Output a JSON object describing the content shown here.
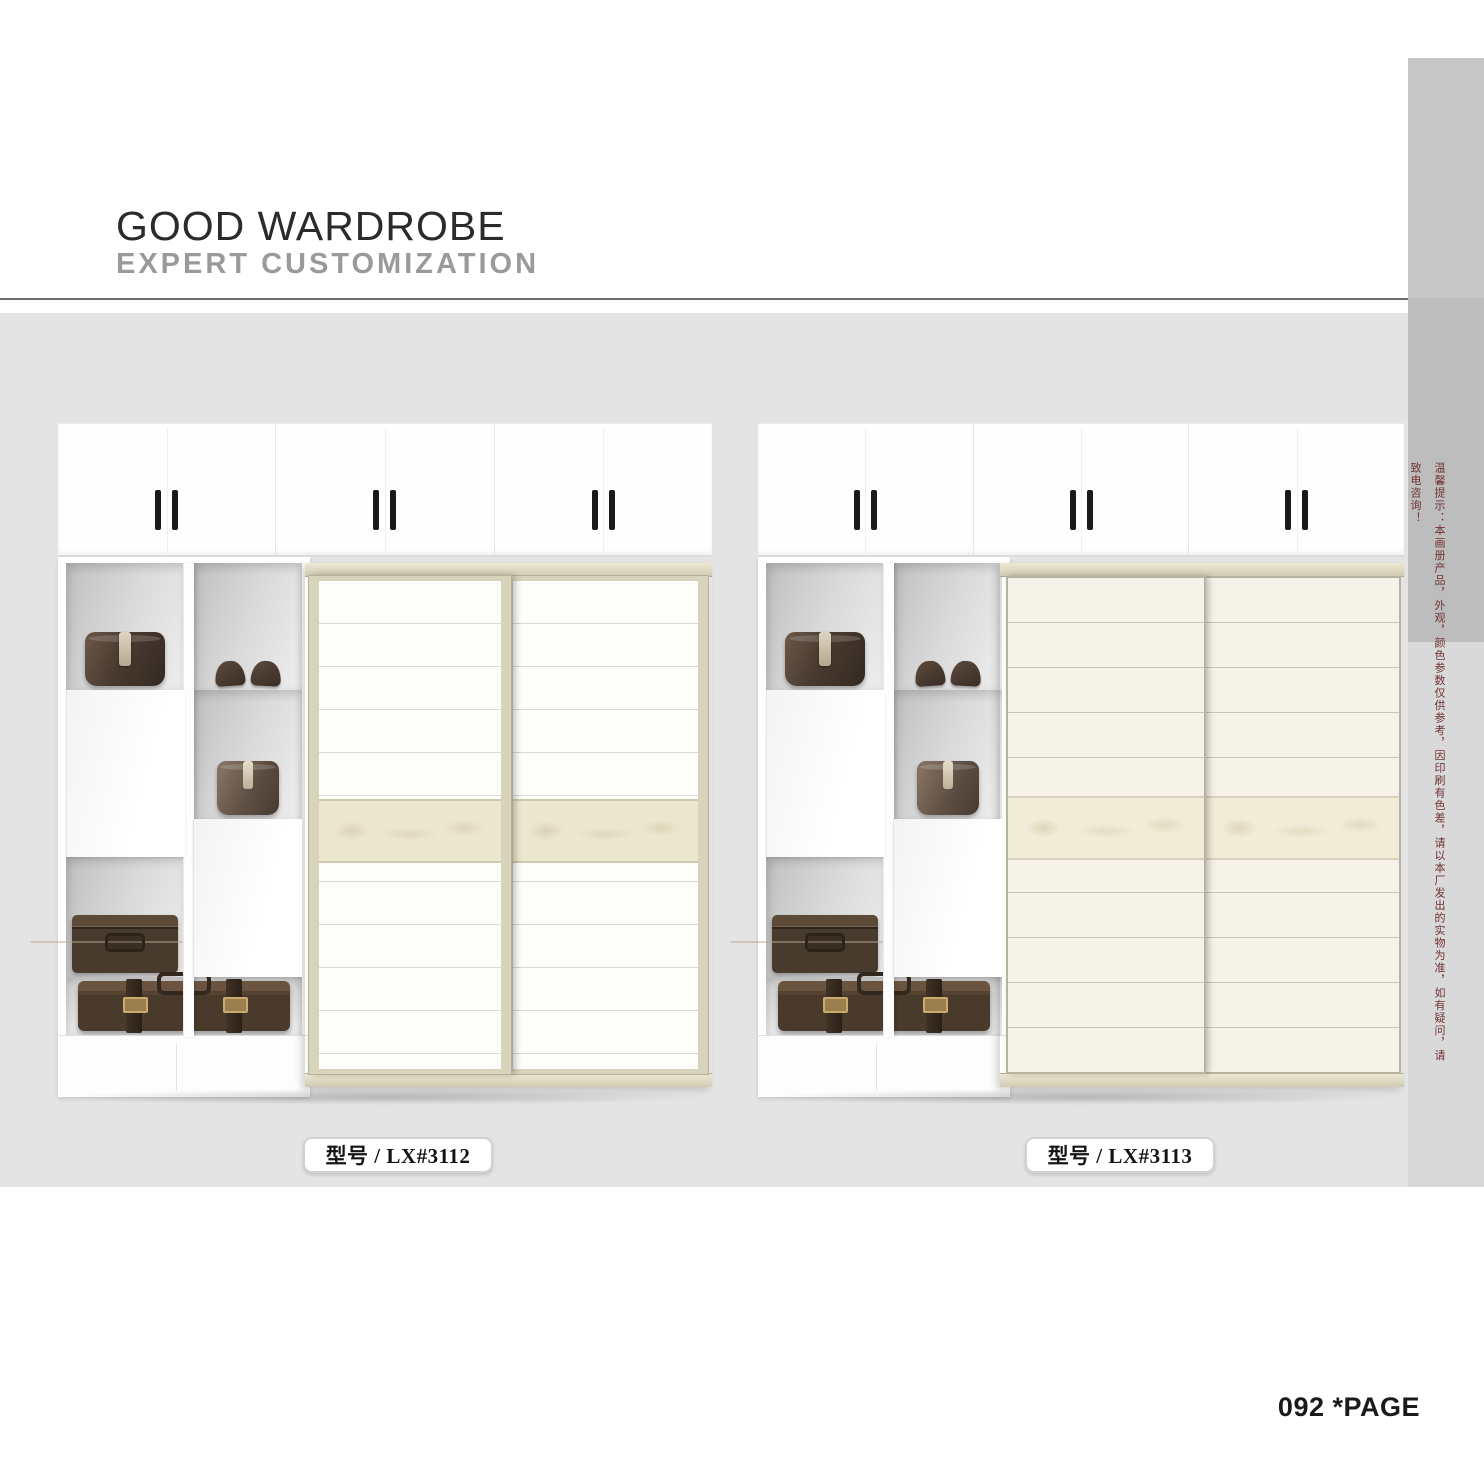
{
  "header": {
    "title": "GOOD WARDROBE",
    "subtitle": "EXPERT CUSTOMIZATION"
  },
  "side_note": {
    "text": "温馨提示：本画册产品，外观，颜色参数仅供参考，因印刷有色差，请以本厂发出的实物为准，如有疑问，请致电咨询！",
    "color": "#703232"
  },
  "products": [
    {
      "model_label": "型号 / LX#3112",
      "props": [
        "hat-box",
        "shoes",
        "storage-box",
        "trunk-case",
        "suitcase"
      ],
      "finish": {
        "panel": "#fdfdfb",
        "frame": "#d8d4bb",
        "accent_band": "#ece7cf"
      }
    },
    {
      "model_label": "型号 / LX#3113",
      "props": [
        "hat-box",
        "shoes",
        "storage-box",
        "trunk-case",
        "suitcase"
      ],
      "finish": {
        "panel": "#f5f2e9",
        "frame": "#b7b3a0",
        "accent_band": "#f1ecd8"
      }
    }
  ],
  "footer": {
    "page_label": "092 *PAGE"
  },
  "colors": {
    "band": "#e4e4e4",
    "sidebar_top": "#c7c7c7",
    "sidebar_mid": "#bdbdbd",
    "sidebar_low": "#d9d9d9",
    "subtitle_gray": "#9a9a9a",
    "handle_black": "#1a1a1a"
  }
}
